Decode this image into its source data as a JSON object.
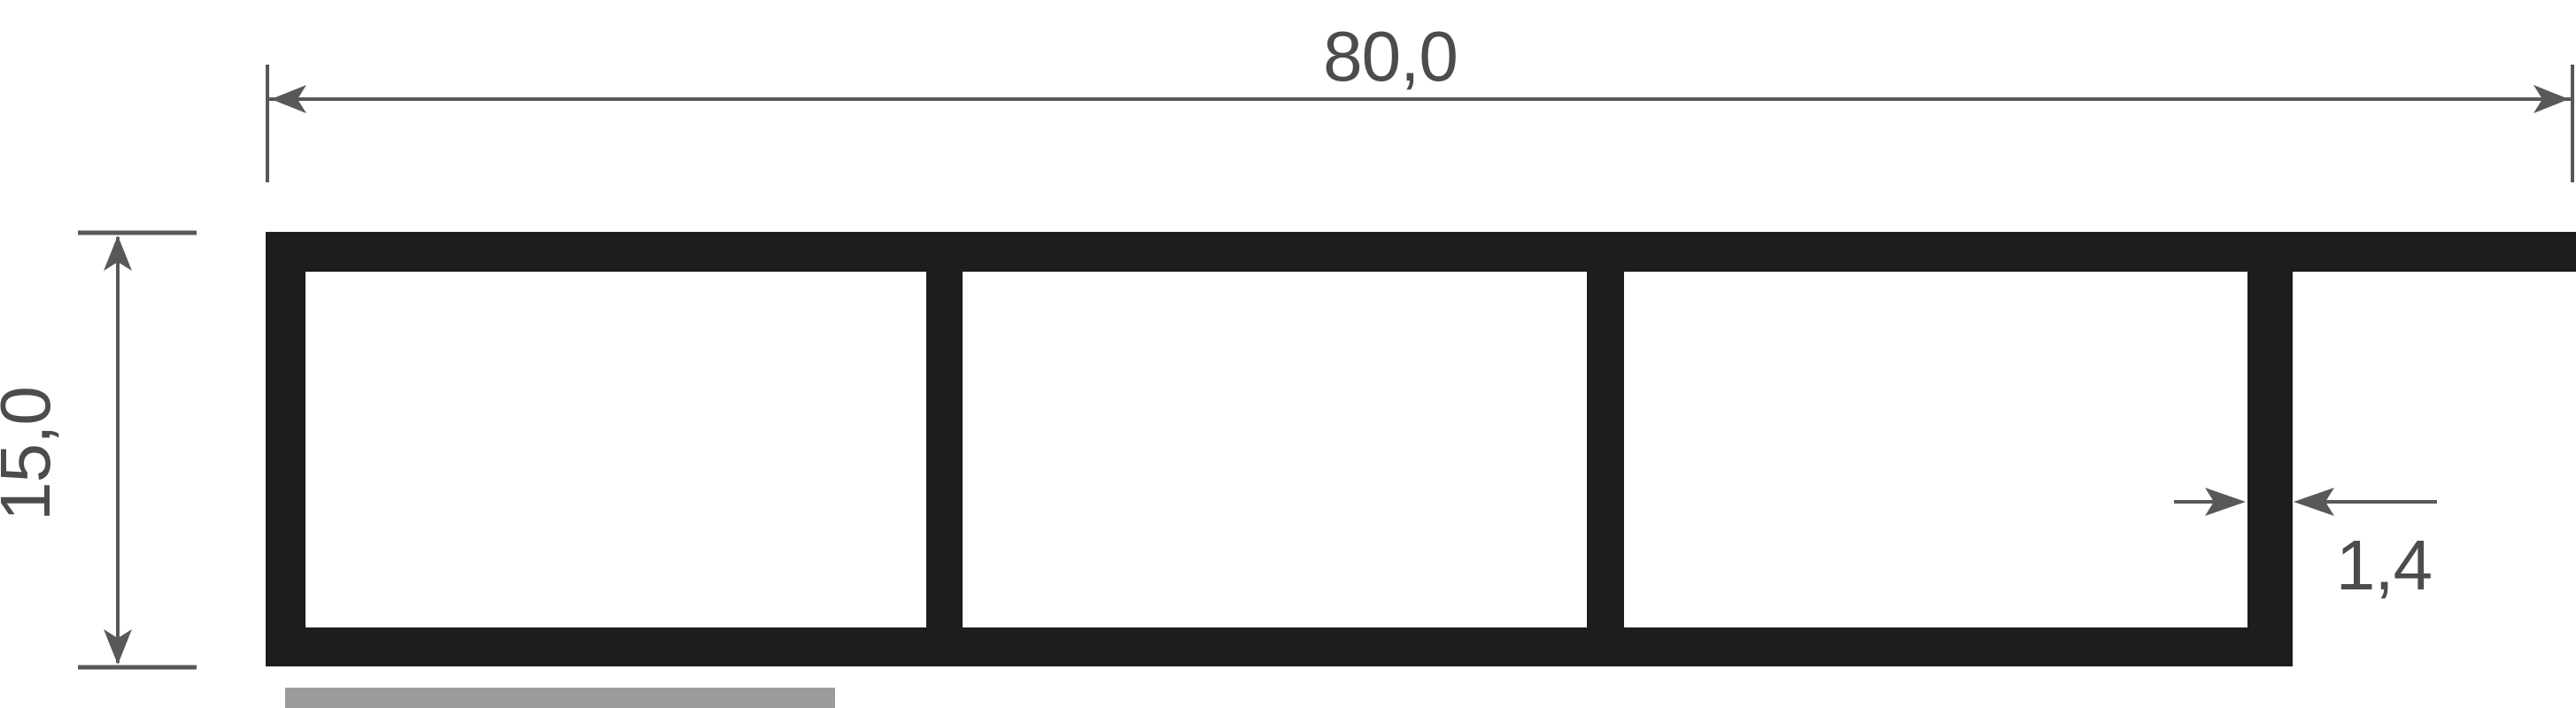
{
  "drawing": {
    "type": "technical-profile-cross-section",
    "dimensions": {
      "width": {
        "label": "80,0"
      },
      "height": {
        "label": "15,0"
      },
      "wall_thickness": {
        "label": "1,4"
      }
    },
    "colors": {
      "profile": "#1e1c1c",
      "dimension_lines": "#57585a",
      "dimension_text": "#4c4c4e",
      "material_bar": "#9b9b9b",
      "background": "#ffffff"
    }
  }
}
